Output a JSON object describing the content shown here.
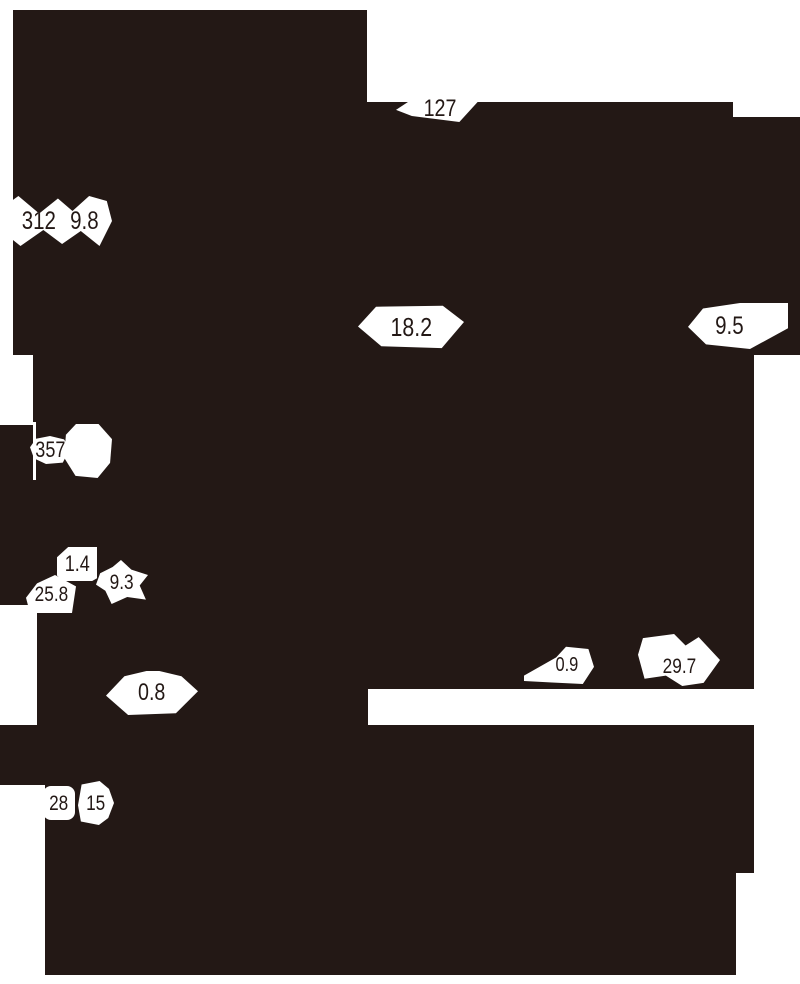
{
  "colors": {
    "ink": "#231815",
    "paper": "#ffffff"
  },
  "figure": {
    "kind": "technical-drawing-silhouette",
    "dimensions": [
      {
        "id": "127",
        "value": "127"
      },
      {
        "id": "312",
        "value": "312"
      },
      {
        "id": "9.8",
        "value": "9.8"
      },
      {
        "id": "18.2",
        "value": "18.2"
      },
      {
        "id": "9.5",
        "value": "9.5"
      },
      {
        "id": "357",
        "value": "357"
      },
      {
        "id": "1.4",
        "value": "1.4"
      },
      {
        "id": "25.8",
        "value": "25.8"
      },
      {
        "id": "9.3",
        "value": "9.3"
      },
      {
        "id": "0.8",
        "value": "0.8"
      },
      {
        "id": "0.9",
        "value": "0.9"
      },
      {
        "id": "29.7",
        "value": "29.7"
      },
      {
        "id": "28",
        "value": "28"
      },
      {
        "id": "15",
        "value": "15"
      }
    ]
  }
}
